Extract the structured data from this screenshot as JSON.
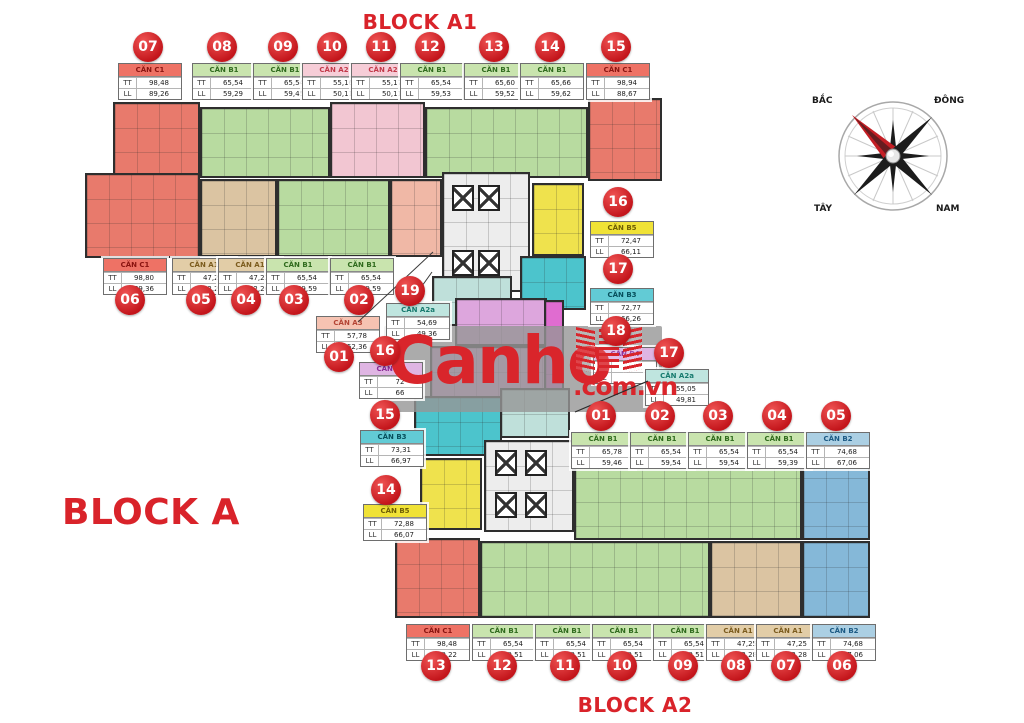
{
  "titles": {
    "block_a1": "BLOCK A1",
    "block_a": "BLOCK A",
    "block_a2": "BLOCK A2"
  },
  "compass": {
    "north": "BẮC",
    "east": "ĐÔNG",
    "west": "TÂY",
    "south": "NAM"
  },
  "watermark": {
    "brand": "Canho",
    "domain": ".com.vn"
  },
  "row_labels": {
    "tt": "TT",
    "ll": "LL"
  },
  "colors": {
    "accent_red": "#d9232a",
    "circle_red": "#cf1a20",
    "core": "#ededed",
    "magenta": "#e06cd0",
    "types": {
      "c1": {
        "header": "#ee7265",
        "text": "#8a1410",
        "plan": "#e87a6c"
      },
      "b1": {
        "header": "#c9e4ae",
        "text": "#2f6b1d",
        "plan": "#b8dba0"
      },
      "a2": {
        "header": "#f6cdd7",
        "text": "#c23a4a",
        "plan": "#f2c6d2"
      },
      "a1": {
        "header": "#e2cda7",
        "text": "#7c5c1e",
        "plan": "#dbc4a2"
      },
      "a3": {
        "header": "#f6c3b2",
        "text": "#b44434",
        "plan": "#f0b8a6"
      },
      "a2a": {
        "header": "#bfe5df",
        "text": "#177a6e",
        "plan": "#bfe0da"
      },
      "b5": {
        "header": "#f0e236",
        "text": "#6e5e04",
        "plan": "#efe24d"
      },
      "b3": {
        "header": "#62cbd5",
        "text": "#074f5c",
        "plan": "#4cc4cc"
      },
      "b4": {
        "header": "#dfb5e3",
        "text": "#8a2a96",
        "plan": "#dda6dd"
      },
      "b2": {
        "header": "#abcfe3",
        "text": "#1c5a84",
        "plan": "#85b8d8"
      }
    }
  },
  "labels": [
    {
      "id": "a1-07",
      "num": "07",
      "name": "CĂN C1",
      "tt": "98,48",
      "ll": "89,26",
      "type": "c1"
    },
    {
      "id": "a1-08",
      "num": "08",
      "name": "CĂN B1",
      "tt": "65,54",
      "ll": "59,29",
      "type": "b1"
    },
    {
      "id": "a1-09",
      "num": "09",
      "name": "CĂN B1",
      "tt": "65,54",
      "ll": "59,45",
      "type": "b1"
    },
    {
      "id": "a1-10",
      "num": "10",
      "name": "CĂN A2",
      "tt": "55,16",
      "ll": "50,11",
      "type": "a2"
    },
    {
      "id": "a1-11",
      "num": "11",
      "name": "CĂN A2",
      "tt": "55,17",
      "ll": "50,11",
      "type": "a2"
    },
    {
      "id": "a1-12",
      "num": "12",
      "name": "CĂN B1",
      "tt": "65,54",
      "ll": "59,53",
      "type": "b1"
    },
    {
      "id": "a1-13",
      "num": "13",
      "name": "CĂN B1",
      "tt": "65,60",
      "ll": "59,52",
      "type": "b1"
    },
    {
      "id": "a1-14",
      "num": "14",
      "name": "CĂN B1",
      "tt": "65,66",
      "ll": "59,62",
      "type": "b1"
    },
    {
      "id": "a1-15",
      "num": "15",
      "name": "CĂN C1",
      "tt": "98,94",
      "ll": "88,67",
      "type": "c1"
    },
    {
      "id": "a1-06",
      "num": "06",
      "name": "CĂN C1",
      "tt": "98,80",
      "ll": "89,36",
      "type": "c1"
    },
    {
      "id": "a1-05",
      "num": "05",
      "name": "CĂN A1",
      "tt": "47,25",
      "ll": "42,26",
      "type": "a1"
    },
    {
      "id": "a1-04",
      "num": "04",
      "name": "CĂN A1",
      "tt": "47,22",
      "ll": "42,26",
      "type": "a1"
    },
    {
      "id": "a1-03",
      "num": "03",
      "name": "CĂN B1",
      "tt": "65,54",
      "ll": "59,59",
      "type": "b1"
    },
    {
      "id": "a1-02",
      "num": "02",
      "name": "CĂN B1",
      "tt": "65,54",
      "ll": "59,59",
      "type": "b1"
    },
    {
      "id": "a1-19",
      "num": "19",
      "name": "CĂN A2a",
      "tt": "54,69",
      "ll": "49,36",
      "type": "a2a"
    },
    {
      "id": "a1-01",
      "num": "01",
      "name": "CĂN A3",
      "tt": "57,78",
      "ll": "52,36",
      "type": "a3"
    },
    {
      "id": "a1-16",
      "num": "16",
      "name": "CĂN B5",
      "tt": "72,47",
      "ll": "66,11",
      "type": "b5"
    },
    {
      "id": "a1-17",
      "num": "17",
      "name": "CĂN B3",
      "tt": "72,77",
      "ll": "66,26",
      "type": "b3"
    },
    {
      "id": "a1-18",
      "num": "18",
      "name": "CĂN B4",
      "tt": "",
      "ll": "",
      "type": "b4"
    },
    {
      "id": "a2-17",
      "num": "17",
      "name": "CĂN A2a",
      "tt": "55,05",
      "ll": "49,81",
      "type": "a2a"
    },
    {
      "id": "a2-01",
      "num": "01",
      "name": "CĂN B1",
      "tt": "65,78",
      "ll": "59,46",
      "type": "b1"
    },
    {
      "id": "a2-02",
      "num": "02",
      "name": "CĂN B1",
      "tt": "65,54",
      "ll": "59,54",
      "type": "b1"
    },
    {
      "id": "a2-03",
      "num": "03",
      "name": "CĂN B1",
      "tt": "65,54",
      "ll": "59,54",
      "type": "b1"
    },
    {
      "id": "a2-04",
      "num": "04",
      "name": "CĂN B1",
      "tt": "65,54",
      "ll": "59,39",
      "type": "b1"
    },
    {
      "id": "a2-05",
      "num": "05",
      "name": "CĂN B2",
      "tt": "74,68",
      "ll": "67,06",
      "type": "b2"
    },
    {
      "id": "a2-16",
      "num": "16",
      "name": "CĂN B4",
      "tt": "72",
      "ll": "66",
      "type": "b4"
    },
    {
      "id": "a2-15",
      "num": "15",
      "name": "CĂN B3",
      "tt": "73,31",
      "ll": "66,97",
      "type": "b3"
    },
    {
      "id": "a2-14",
      "num": "14",
      "name": "CĂN B5",
      "tt": "72,88",
      "ll": "66,07",
      "type": "b5"
    },
    {
      "id": "a2-13",
      "num": "13",
      "name": "CĂN C1",
      "tt": "98,48",
      "ll": "89,22",
      "type": "c1"
    },
    {
      "id": "a2-12",
      "num": "12",
      "name": "CĂN B1",
      "tt": "65,54",
      "ll": "59,51",
      "type": "b1"
    },
    {
      "id": "a2-11",
      "num": "11",
      "name": "CĂN B1",
      "tt": "65,54",
      "ll": "59,51",
      "type": "b1"
    },
    {
      "id": "a2-10",
      "num": "10",
      "name": "CĂN B1",
      "tt": "65,54",
      "ll": "59,51",
      "type": "b1"
    },
    {
      "id": "a2-09",
      "num": "09",
      "name": "CĂN B1",
      "tt": "65,54",
      "ll": "59,51",
      "type": "b1"
    },
    {
      "id": "a2-08",
      "num": "08",
      "name": "CĂN A1",
      "tt": "47,25",
      "ll": "42,28",
      "type": "a1"
    },
    {
      "id": "a2-07",
      "num": "07",
      "name": "CĂN A1",
      "tt": "47,25",
      "ll": "42,28",
      "type": "a1"
    },
    {
      "id": "a2-06",
      "num": "06",
      "name": "CĂN B2",
      "tt": "74,68",
      "ll": "67,06",
      "type": "b2"
    }
  ]
}
